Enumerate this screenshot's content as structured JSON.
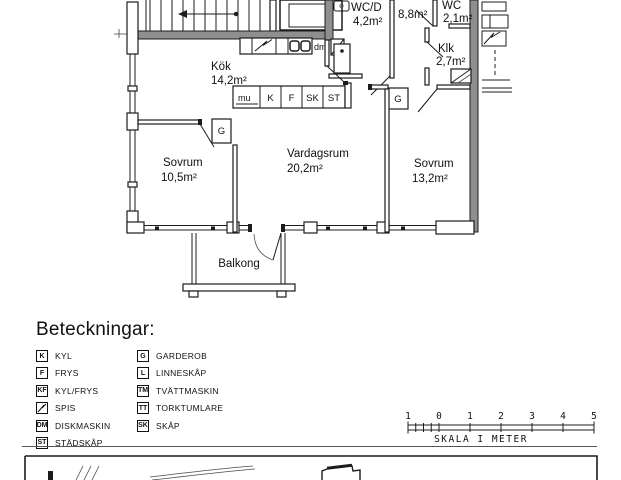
{
  "colors": {
    "wall_gray": "#8f8f8f",
    "line": "#1c1c1c",
    "background": "#ffffff"
  },
  "plan": {
    "rooms": [
      {
        "name": "Kök",
        "area": "14,2m²"
      },
      {
        "name": "WC/D",
        "area": "4,2m²"
      },
      {
        "name": "",
        "area": "8,8m²"
      },
      {
        "name": "WC",
        "area": "2,1m²"
      },
      {
        "name": "Klk",
        "area": "2,7m²"
      },
      {
        "name": "Sovrum",
        "area": "10,5m²"
      },
      {
        "name": "Vardagsrum",
        "area": "20,2m²"
      },
      {
        "name": "Sovrum",
        "area": "13,2m²"
      },
      {
        "name": "Balkong",
        "area": ""
      }
    ],
    "fixtures": {
      "counter_label": "mu",
      "units": [
        "K",
        "F",
        "SK",
        "ST"
      ],
      "dishwasher": "dm",
      "wardrobe": "G"
    }
  },
  "legend": {
    "title": "Beteckningar:",
    "col1": [
      {
        "code": "K",
        "label": "KYL"
      },
      {
        "code": "F",
        "label": "FRYS"
      },
      {
        "code": "KF",
        "label": "KYL/FRYS"
      },
      {
        "code": "",
        "label": "SPIS"
      },
      {
        "code": "DM",
        "label": "DISKMASKIN"
      },
      {
        "code": "ST",
        "label": "STÄDSKÅP"
      }
    ],
    "col2": [
      {
        "code": "G",
        "label": "GARDEROB"
      },
      {
        "code": "L",
        "label": "LINNESKÅP"
      },
      {
        "code": "TM",
        "label": "TVÄTTMASKIN"
      },
      {
        "code": "TT",
        "label": "TORKTUMLARE"
      },
      {
        "code": "SK",
        "label": "SKÅP"
      }
    ]
  },
  "scalebar": {
    "labels": [
      "1",
      "0",
      "1",
      "2",
      "3",
      "4",
      "5"
    ],
    "caption": "SKALA I METER"
  }
}
